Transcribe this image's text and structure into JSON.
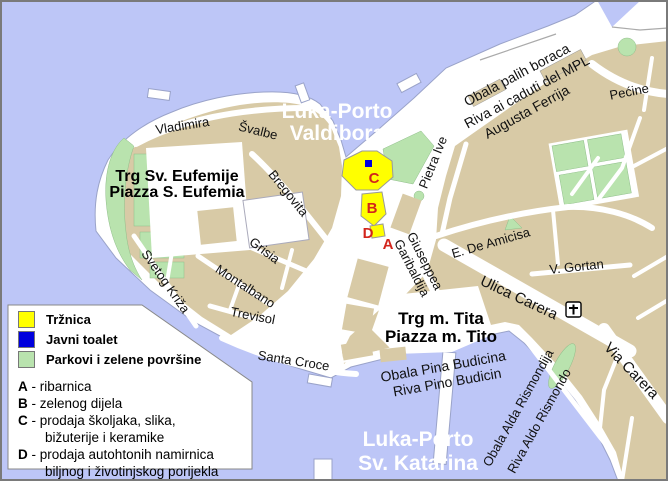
{
  "map": {
    "title": "Rovinj town map",
    "colors": {
      "water": "#bdc6f7",
      "land": "#d8caa6",
      "park": "#b9e3ae",
      "street": "#ffffff",
      "market_zone": "#ffff00",
      "public_toilet": "#0000dd",
      "marker_red": "#d2251c",
      "frame": "#7a7a7a",
      "water_label_text": "#ffffff"
    },
    "water_labels": {
      "valdibora": [
        "Luka-Porto",
        "Valdibora"
      ],
      "katarina": [
        "Luka-Porto",
        "Sv. Katarina"
      ]
    },
    "places": {
      "eufemija": [
        "Trg Sv. Eufemije",
        "Piazza S. Eufemia"
      ],
      "tito": [
        "Trg m. Tita",
        "Piazza m. Tito"
      ]
    },
    "streets": {
      "vladimira": "Vladimira",
      "svalbe": "Švalbe",
      "bregovita": "Bregovita",
      "grisia": "Grisia",
      "montalbano": "Montalbano",
      "trevisol": "Trevisol",
      "santa_croce": "Santa Croce",
      "svetog_kriza": "Svetog Križa",
      "pietra_ive": "Pietra Ive",
      "obala_palih": "Obala palih boraca",
      "riva_caduti": "Riva ai caduti del MPL",
      "augusta_ferrija": "Augusta Ferrija",
      "pecine": "Pećine",
      "de_amicisa": "E. De Amicisa",
      "gortan": "V. Gortan",
      "ulica_carera": "Ulica Carera",
      "via_carera": "Via Carera",
      "giuseppea": "Giuseppea",
      "garibaldija": "Garibaldija",
      "obala_pina": "Obala Pina Budicina",
      "riva_pino": "Riva Pino Budicin",
      "obala_alda": "Obala Alda Rismondija",
      "riva_aldo": "Riva Aldo Rismondo"
    },
    "map_markers": {
      "a": "A",
      "b": "B",
      "c": "C",
      "d": "D"
    }
  },
  "legend": {
    "sep": " - ",
    "items": [
      {
        "color": "#ffff00",
        "label": "Tržnica"
      },
      {
        "color": "#0000dd",
        "label": "Javni toalet"
      },
      {
        "color": "#b9e3ae",
        "label": "Parkovi i zelene površine"
      }
    ],
    "markers": [
      {
        "key": "A",
        "lines": [
          "ribarnica"
        ]
      },
      {
        "key": "B",
        "lines": [
          "zelenog dijela"
        ]
      },
      {
        "key": "C",
        "lines": [
          "prodaja školjaka, slika,",
          "bižuterije i keramike"
        ]
      },
      {
        "key": "D",
        "lines": [
          "prodaja autohtonih namirnica",
          "biljnog i životinjskog porijekla"
        ]
      }
    ]
  }
}
